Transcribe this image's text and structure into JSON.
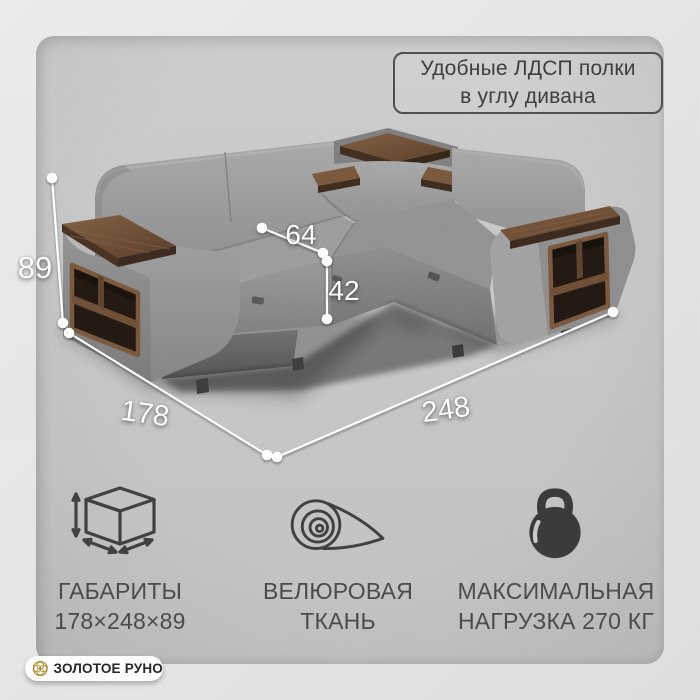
{
  "badge": {
    "line1": "Удобные ЛДСП полки",
    "line2": "в углу дивана"
  },
  "dims": {
    "height": "89",
    "seat_depth": "64",
    "seat_height": "42",
    "width": "178",
    "length": "248"
  },
  "features": [
    {
      "icon": "cube-dimensions-icon",
      "title": "ГАБАРИТЫ",
      "value": "178×248×89"
    },
    {
      "icon": "fabric-roll-icon",
      "title": "ВЕЛЮРОВАЯ",
      "value": "ТКАНЬ"
    },
    {
      "icon": "kettlebell-icon",
      "title": "МАКСИМАЛЬНАЯ",
      "value": "НАГРУЗКА 270 КГ"
    }
  ],
  "brand": {
    "name": "ЗОЛОТОЕ РУНО"
  },
  "colors": {
    "background": "#e7e7e7",
    "card": "#c7c7c7",
    "sofa_fabric": "#969696",
    "wood": "#6b4a33",
    "shelf_interior": "#20160f",
    "dimension_lines": "#ffffff",
    "text": "#4b4b4b",
    "badge_border": "#4f4f4f",
    "brand_gold": "#b28a28",
    "brand_pill": "#ffffff"
  }
}
